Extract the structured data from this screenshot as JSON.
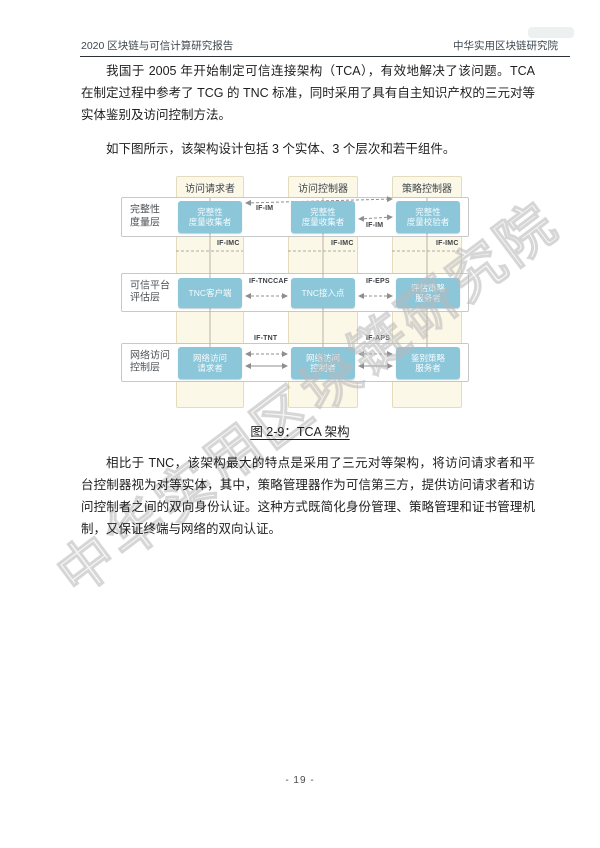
{
  "header": {
    "left": "2020 区块链与可信计算研究报告",
    "right": "中华实用区块链研究院"
  },
  "paragraphs": {
    "p1": "我国于 2005 年开始制定可信连接架构（TCA），有效地解决了该问题。TCA 在制定过程中参考了 TCG 的 TNC 标准，同时采用了具有自主知识产权的三元对等实体鉴别及访问控制方法。",
    "p2": "如下图所示，该架构设计包括 3 个实体、3 个层次和若干组件。",
    "p3": "相比于 TNC，该架构最大的特点是采用了三元对等架构，将访问请求者和平台控制器视为对等实体，其中，策略管理器作为可信第三方，提供访问请求者和访问控制者之间的双向身份认证。这种方式既简化身份管理、策略管理和证书管理机制，又保证终端与网络的双向认证。"
  },
  "diagram": {
    "columns": [
      "访问请求者",
      "访问控制器",
      "策略控制器"
    ],
    "layers": [
      {
        "label": [
          "完整性",
          "度量层"
        ],
        "nodes": [
          [
            "完整性",
            "度量收集者"
          ],
          [
            "完整性",
            "度量收集者"
          ],
          [
            "完整性",
            "度量校验者"
          ]
        ]
      },
      {
        "label": [
          "可信平台",
          "评估层"
        ],
        "nodes": [
          [
            "TNC客户端"
          ],
          [
            "TNC接入点"
          ],
          [
            "评估策略",
            "服务者"
          ]
        ]
      },
      {
        "label": [
          "网络访问",
          "控制层"
        ],
        "nodes": [
          [
            "网络访问",
            "请求者"
          ],
          [
            "网络访问",
            "控制者"
          ],
          [
            "鉴别策略",
            "服务者"
          ]
        ]
      }
    ],
    "interface_labels": {
      "im1": "IF-IM",
      "im2": "IF-IM",
      "imc1": "IF-IMC",
      "imc2": "IF-IMC",
      "imc3": "IF-IMC",
      "tnccaf": "IF-TNCCAF",
      "eps": "IF-EPS",
      "tnt": "IF-TNT",
      "aps": "IF-APS"
    },
    "colors": {
      "node_fill": "#8cc6d9",
      "strip_fill": "#fcf8e8",
      "strip_border": "#e5dbbd",
      "band_border": "#c8c8c8",
      "arrow": "#999999"
    }
  },
  "figure": {
    "caption": "图 2-9：TCA 架构"
  },
  "watermark": {
    "text": "中华实用区块链研究院"
  },
  "footer": {
    "page_number": "- 19 -"
  }
}
